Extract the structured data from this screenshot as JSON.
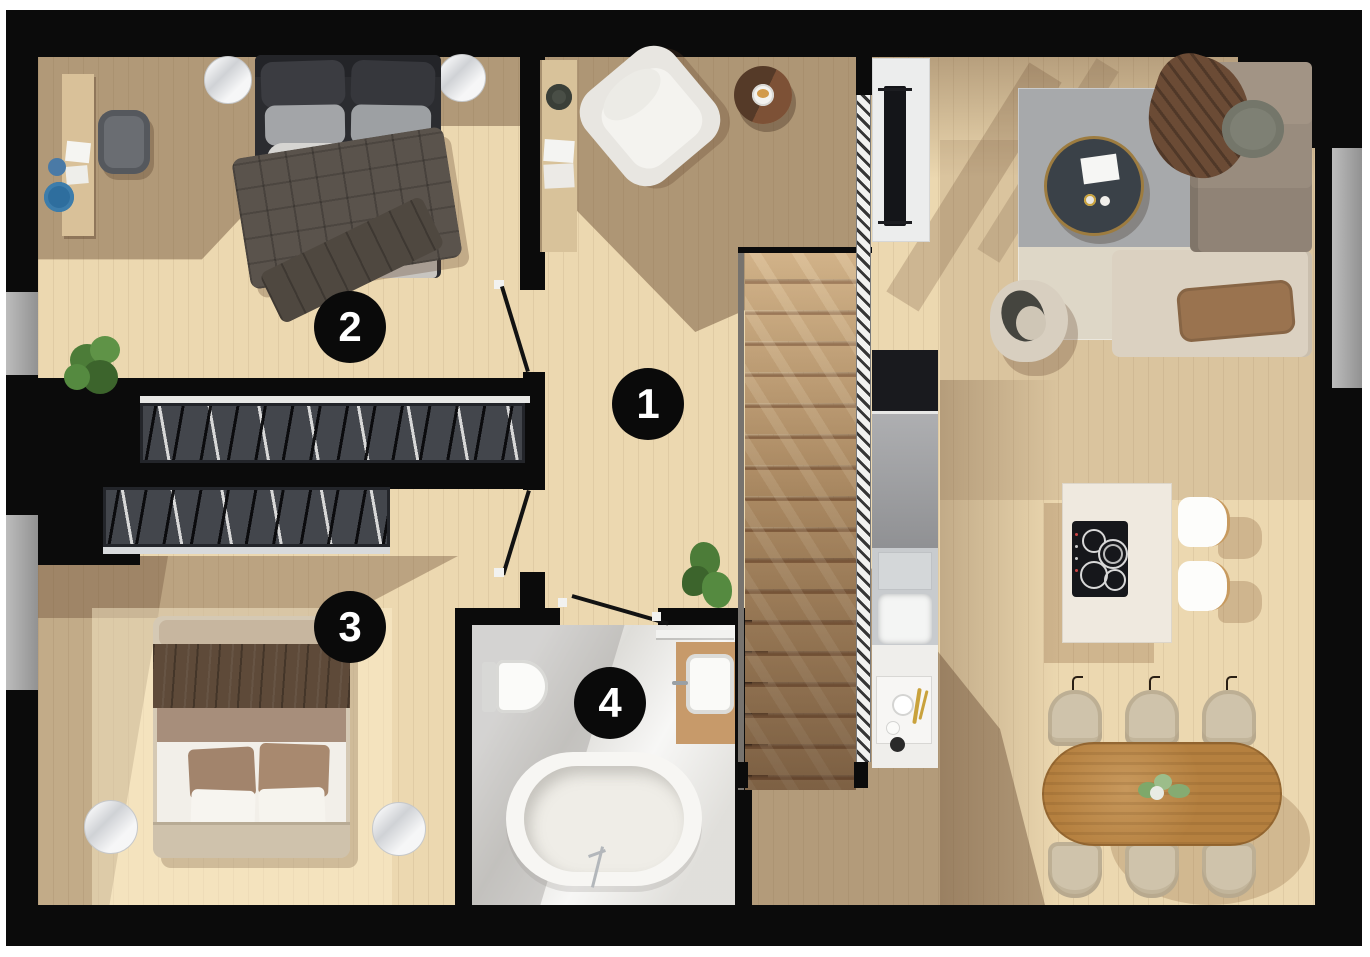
{
  "plan_type": "apartment-floor-plan-top-view",
  "markers": [
    {
      "label": "1"
    },
    {
      "label": "2"
    },
    {
      "label": "3"
    },
    {
      "label": "4"
    }
  ],
  "marker_style": {
    "background": "#0a0a0a",
    "text": "#ffffff"
  },
  "palette": {
    "wall": "#0b0b0b",
    "floor_light_wood": "#ecd8b0",
    "floor_shadow_brown": "#6b4b33",
    "window_glass": "#a6a6a6",
    "wardrobe_interior": "#43464c",
    "bathroom_tile": "#e9e8e4",
    "stair_wood": "#b08a5f",
    "railing_hatch": "#f2f2f0",
    "counter_grey": "#9c9da0",
    "kitchen_island": "#efe9df",
    "hob_black": "#16171b",
    "dining_table_wood": "#b5803f",
    "dining_chair": "#cfc3ab",
    "sofa_taupe": "#a29485",
    "sofa_beige": "#dbd1c1",
    "rug_grey": "#a7a9ab",
    "rug_cream": "#ded7c7",
    "coffee_table": "#3a4148",
    "bed_dark": "#2b2c30",
    "bed3_frame": "#d5c9b4",
    "plant_green": "#4c7c38",
    "marble_white": "#e9eaec",
    "accent_blue": "#2e6e9e",
    "accent_gold": "#c9a23c"
  }
}
